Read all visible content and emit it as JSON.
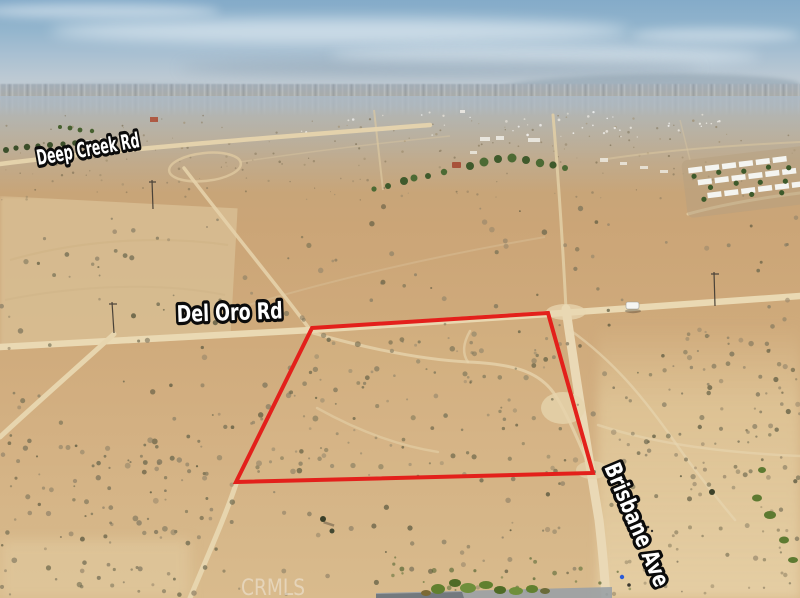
{
  "photo": {
    "road_labels": [
      {
        "label": "Deep Creek Rd"
      },
      {
        "label": "Del Oro Rd"
      },
      {
        "label": "Brisbane Ave"
      }
    ],
    "watermark": "CRMLS",
    "boundary": {
      "color": "#e3201b",
      "points": "312,328 548,313 593,473 236,482"
    }
  }
}
